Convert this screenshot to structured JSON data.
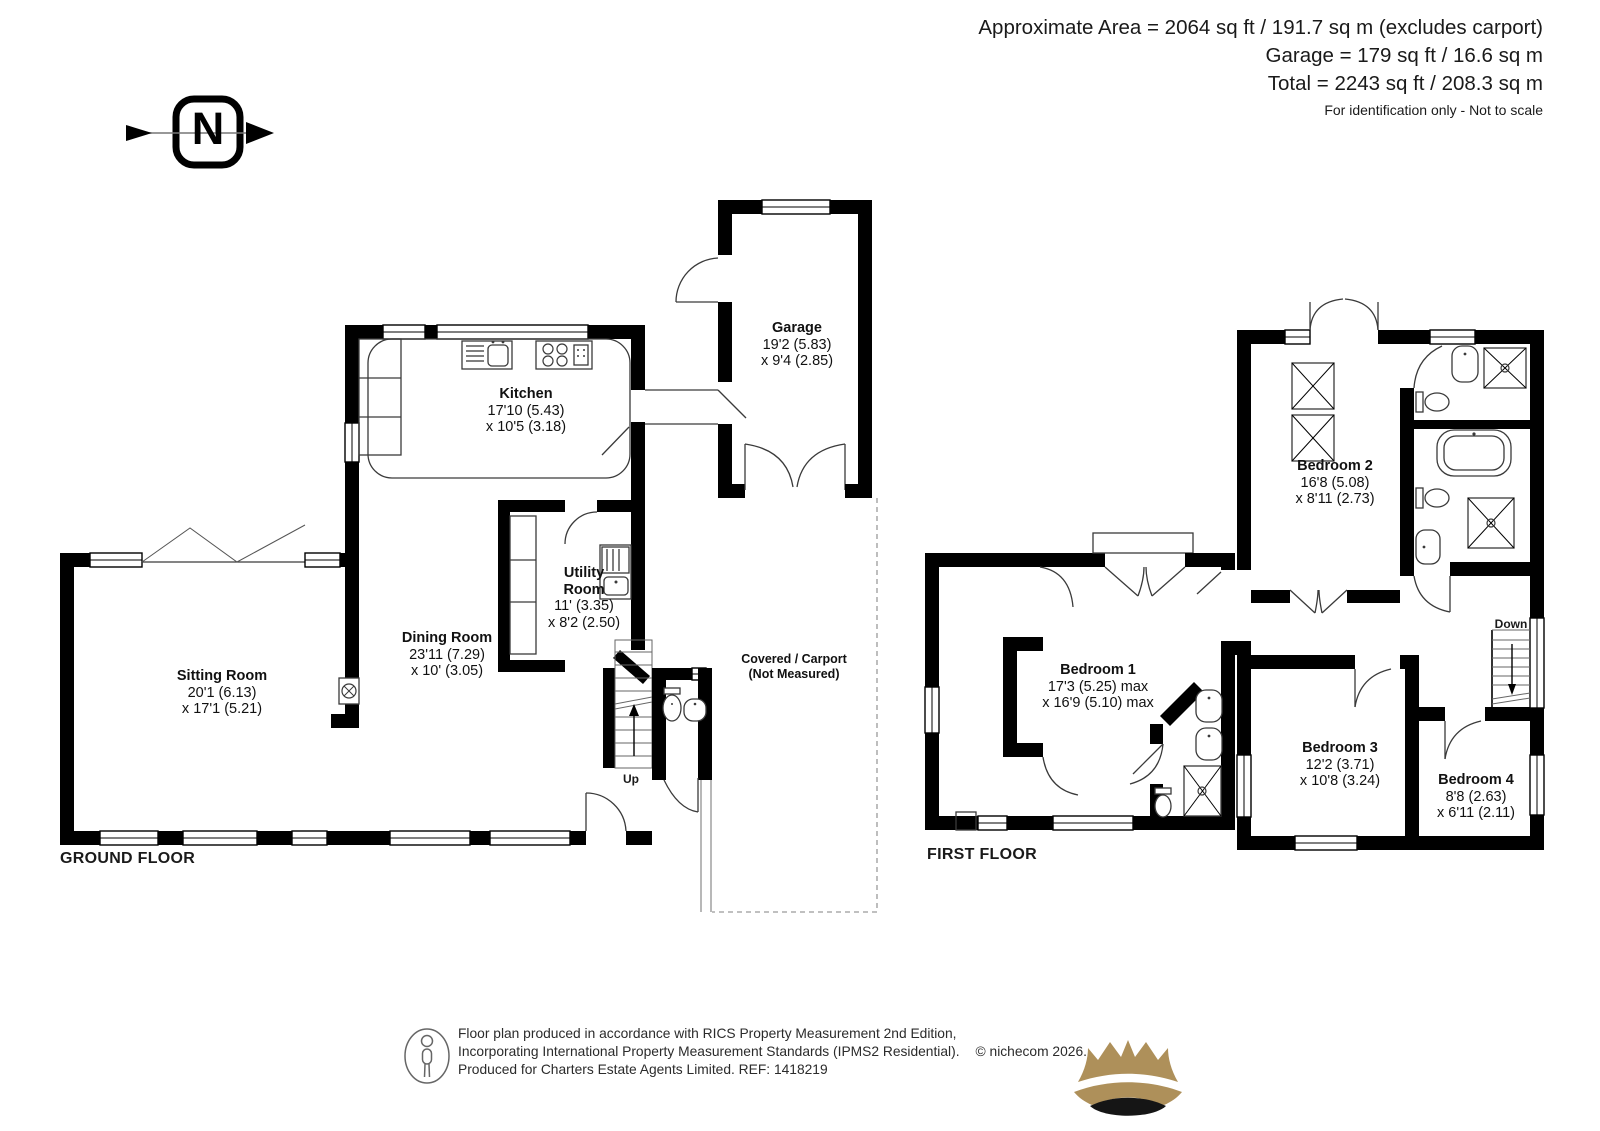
{
  "header": {
    "area_line": "Approximate Area = 2064 sq ft / 191.7 sq m (excludes carport)",
    "garage_line": "Garage = 179 sq ft / 16.6 sq m",
    "total_line": "Total = 2243 sq ft / 208.3 sq m",
    "note": "For identification only - Not to scale"
  },
  "compass": {
    "letter": "N"
  },
  "ground_floor": {
    "title": "GROUND FLOOR",
    "stairs_label": "Up",
    "rooms": {
      "sitting_room": {
        "name": "Sitting Room",
        "d1": "20'1 (6.13)",
        "d2": "x 17'1 (5.21)"
      },
      "dining_room": {
        "name": "Dining Room",
        "d1": "23'11 (7.29)",
        "d2": "x 10' (3.05)"
      },
      "kitchen": {
        "name": "Kitchen",
        "d1": "17'10 (5.43)",
        "d2": "x 10'5 (3.18)"
      },
      "utility_room": {
        "name": "Utility Room",
        "d1": "11' (3.35)",
        "d2": "x 8'2 (2.50)"
      },
      "garage": {
        "name": "Garage",
        "d1": "19'2 (5.83)",
        "d2": "x 9'4 (2.85)"
      },
      "carport": {
        "line1": "Covered /  Carport",
        "line2": "(Not Measured)"
      }
    }
  },
  "first_floor": {
    "title": "FIRST FLOOR",
    "stairs_label": "Down",
    "rooms": {
      "bedroom_1": {
        "name": "Bedroom 1",
        "d1": "17'3 (5.25) max",
        "d2": "x 16'9 (5.10) max"
      },
      "bedroom_2": {
        "name": "Bedroom 2",
        "d1": "16'8 (5.08)",
        "d2": "x 8'11 (2.73)"
      },
      "bedroom_3": {
        "name": "Bedroom 3",
        "d1": "12'2 (3.71)",
        "d2": "x 10'8 (3.24)"
      },
      "bedroom_4": {
        "name": "Bedroom 4",
        "d1": "8'8 (2.63)",
        "d2": "x 6'11 (2.11)"
      }
    }
  },
  "footer": {
    "line1": "Floor plan produced in accordance with RICS Property Measurement 2nd Edition,",
    "line2": "Incorporating International Property Measurement Standards (IPMS2 Residential).",
    "copyright": "© nichecom 2026.",
    "line3": "Produced for Charters Estate Agents Limited.   REF: 1418219"
  },
  "colors": {
    "wall": "#000000",
    "gold": "#AE905A",
    "text": "#1a1a1a"
  }
}
